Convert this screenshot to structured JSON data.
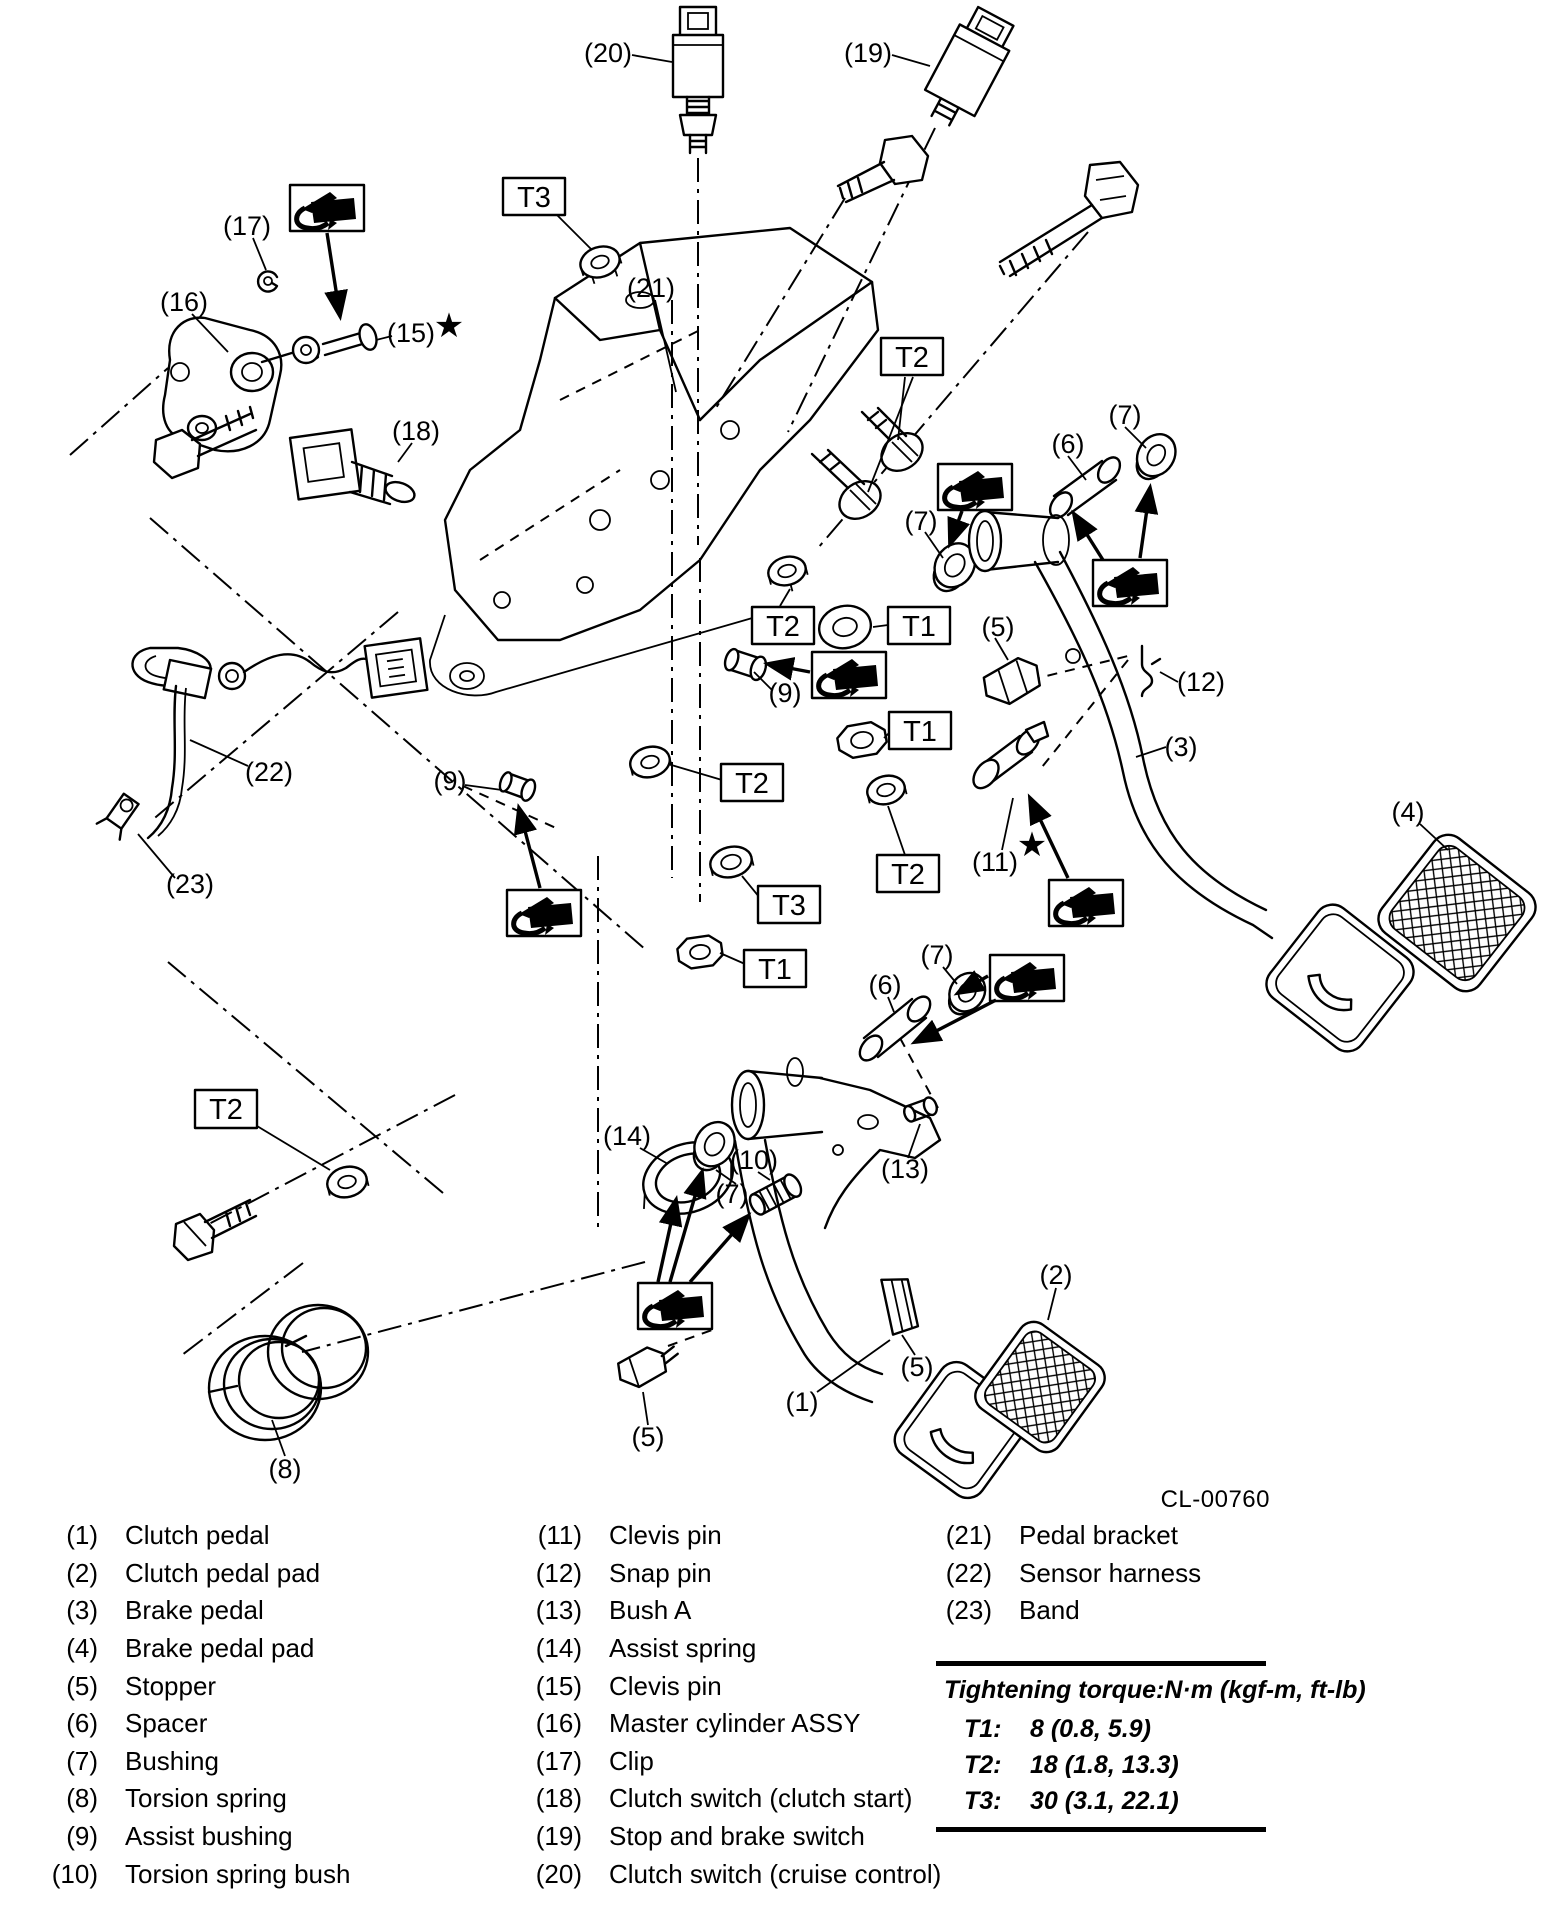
{
  "figure_code": "CL-00760",
  "diagram": {
    "callouts": [
      "(20)",
      "(19)",
      "(17)",
      "(16)",
      "(15)",
      "(18)",
      "(21)",
      "(7)",
      "(6)",
      "(7)",
      "(5)",
      "(12)",
      "(3)",
      "(4)",
      "(9)",
      "(9)",
      "(22)",
      "(23)",
      "(11)",
      "(6)",
      "(7)",
      "(14)",
      "(10)",
      "(7)",
      "(13)",
      "(2)",
      "(5)",
      "(5)",
      "(1)",
      "(8)"
    ],
    "torque_boxes": [
      "T3",
      "T2",
      "T2",
      "T1",
      "T1",
      "T2",
      "T2",
      "T3",
      "T1",
      "T2"
    ],
    "stars": [
      "★",
      "★"
    ]
  },
  "legend": {
    "col1": [
      {
        "num": "(1)",
        "label": "Clutch pedal"
      },
      {
        "num": "(2)",
        "label": "Clutch pedal pad"
      },
      {
        "num": "(3)",
        "label": "Brake pedal"
      },
      {
        "num": "(4)",
        "label": "Brake pedal pad"
      },
      {
        "num": "(5)",
        "label": "Stopper"
      },
      {
        "num": "(6)",
        "label": "Spacer"
      },
      {
        "num": "(7)",
        "label": "Bushing"
      },
      {
        "num": "(8)",
        "label": "Torsion spring"
      },
      {
        "num": "(9)",
        "label": "Assist bushing"
      },
      {
        "num": "(10)",
        "label": "Torsion spring bush"
      }
    ],
    "col2": [
      {
        "num": "(11)",
        "label": "Clevis pin"
      },
      {
        "num": "(12)",
        "label": "Snap pin"
      },
      {
        "num": "(13)",
        "label": "Bush A"
      },
      {
        "num": "(14)",
        "label": "Assist spring"
      },
      {
        "num": "(15)",
        "label": "Clevis pin"
      },
      {
        "num": "(16)",
        "label": "Master cylinder ASSY"
      },
      {
        "num": "(17)",
        "label": "Clip"
      },
      {
        "num": "(18)",
        "label": "Clutch switch (clutch start)"
      },
      {
        "num": "(19)",
        "label": "Stop and brake switch"
      },
      {
        "num": "(20)",
        "label": "Clutch switch (cruise control)"
      }
    ],
    "col3": [
      {
        "num": "(21)",
        "label": "Pedal bracket"
      },
      {
        "num": "(22)",
        "label": "Sensor harness"
      },
      {
        "num": "(23)",
        "label": "Band"
      }
    ]
  },
  "torque_table": {
    "title": "Tightening torque:N·m (kgf-m, ft-lb)",
    "rows": [
      {
        "id": "T1:",
        "value": "8 (0.8, 5.9)"
      },
      {
        "id": "T2:",
        "value": "18 (1.8, 13.3)"
      },
      {
        "id": "T3:",
        "value": "30 (3.1, 22.1)"
      }
    ]
  }
}
